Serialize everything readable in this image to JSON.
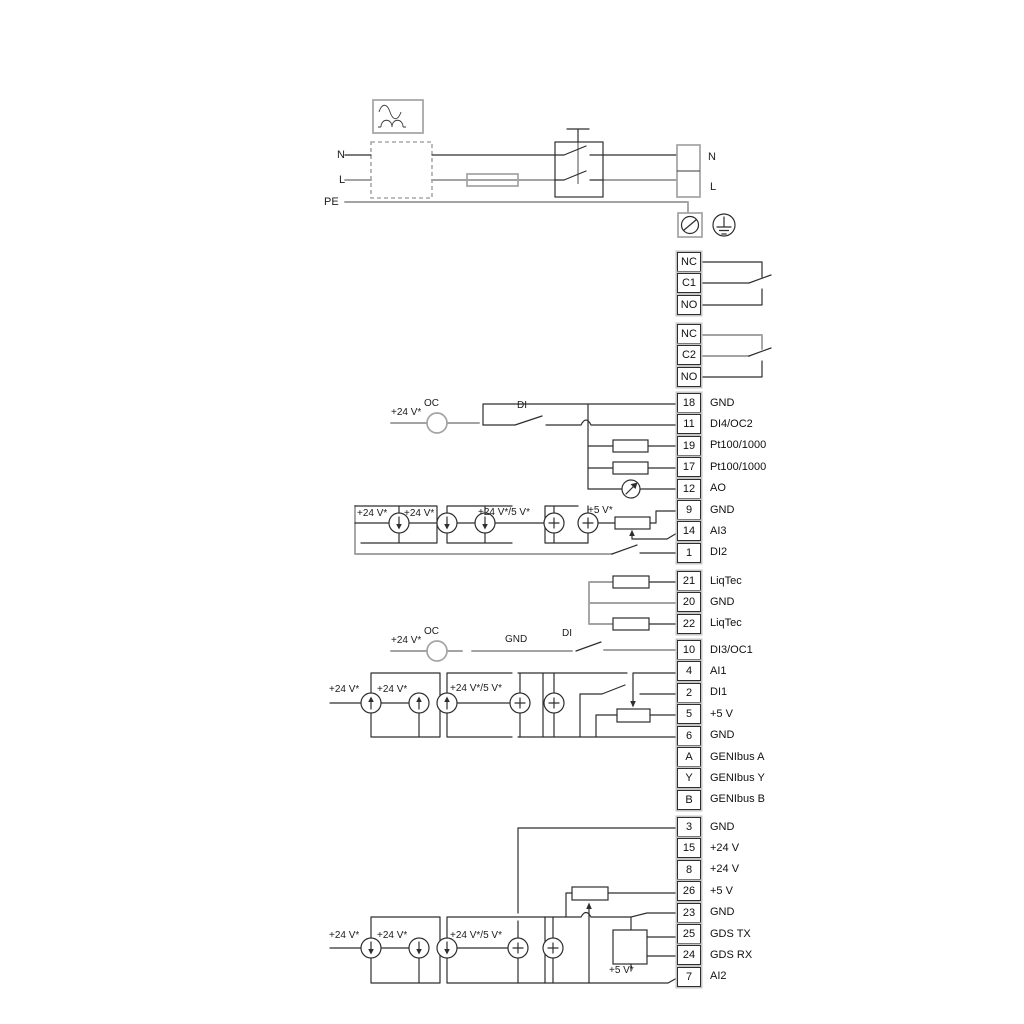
{
  "diagram_title": "Pump control wiring diagram",
  "colors": {
    "background": "#ffffff",
    "wire_dark": "#2e2e2e",
    "wire_gray": "#a3a3a3",
    "text": "#101010"
  },
  "wire_labels": {
    "n_left": "N",
    "l_left": "L",
    "pe": "PE",
    "n_right": "N",
    "l_right": "L",
    "oc1_v24": "+24 V*",
    "oc1": "OC",
    "di4": "DI",
    "ai3_v24_a": "+24 V*",
    "ai3_v24_b": "+24 V*",
    "ai3_v24_5v": "+24 V*/5 V*",
    "ai3_5v": "+5 V*",
    "oc2_v24": "+24 V*",
    "oc2": "OC",
    "gnd_wire": "GND",
    "di3": "DI",
    "ai1_v24_a": "+24 V*",
    "ai1_v24_b": "+24 V*",
    "ai1_v24_5v": "+24 V*/5 V*",
    "ai2_v24_a": "+24 V*",
    "ai2_v24_b": "+24 V*",
    "ai2_v24_5v": "+24 V*/5 V*",
    "ai2_5v": "+5 V*"
  },
  "strips": [
    {
      "name": "relay-1",
      "terminals": [
        {
          "id": "NC",
          "label": ""
        },
        {
          "id": "C1",
          "label": ""
        },
        {
          "id": "NO",
          "label": ""
        }
      ]
    },
    {
      "name": "relay-2",
      "terminals": [
        {
          "id": "NC",
          "label": ""
        },
        {
          "id": "C2",
          "label": ""
        },
        {
          "id": "NO",
          "label": ""
        }
      ]
    },
    {
      "name": "io-top",
      "terminals": [
        {
          "id": "18",
          "label": "GND"
        },
        {
          "id": "11",
          "label": "DI4/OC2"
        },
        {
          "id": "19",
          "label": "Pt100/1000"
        },
        {
          "id": "17",
          "label": "Pt100/1000"
        },
        {
          "id": "12",
          "label": "AO"
        },
        {
          "id": "9",
          "label": "GND"
        },
        {
          "id": "14",
          "label": "AI3"
        },
        {
          "id": "1",
          "label": "DI2"
        }
      ]
    },
    {
      "name": "liqtec",
      "terminals": [
        {
          "id": "21",
          "label": "LiqTec"
        },
        {
          "id": "20",
          "label": "GND"
        },
        {
          "id": "22",
          "label": "LiqTec"
        }
      ]
    },
    {
      "name": "io-mid",
      "terminals": [
        {
          "id": "10",
          "label": "DI3/OC1"
        },
        {
          "id": "4",
          "label": "AI1"
        },
        {
          "id": "2",
          "label": "DI1"
        },
        {
          "id": "5",
          "label": "+5 V"
        },
        {
          "id": "6",
          "label": "GND"
        },
        {
          "id": "A",
          "label": "GENIbus A"
        },
        {
          "id": "Y",
          "label": "GENIbus Y"
        },
        {
          "id": "B",
          "label": "GENIbus B"
        }
      ]
    },
    {
      "name": "io-bottom",
      "terminals": [
        {
          "id": "3",
          "label": "GND"
        },
        {
          "id": "15",
          "label": "+24 V"
        },
        {
          "id": "8",
          "label": "+24 V"
        },
        {
          "id": "26",
          "label": "+5 V"
        },
        {
          "id": "23",
          "label": "GND"
        },
        {
          "id": "25",
          "label": "GDS TX"
        },
        {
          "id": "24",
          "label": "GDS RX"
        },
        {
          "id": "7",
          "label": "AI2"
        }
      ]
    }
  ]
}
